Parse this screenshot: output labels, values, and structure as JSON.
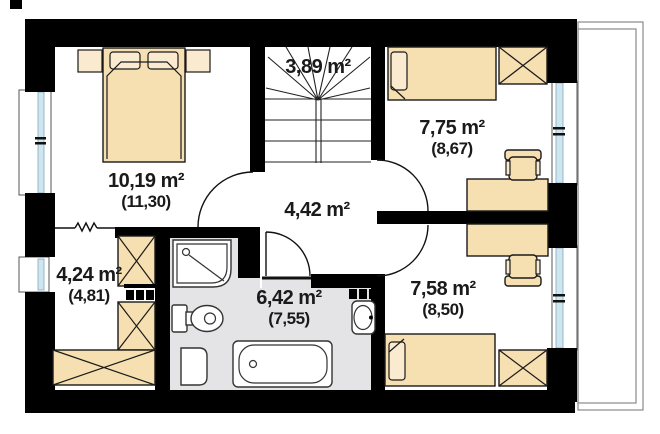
{
  "plan": {
    "type": "floor-plan",
    "rooms": [
      {
        "name": "bedroom-1",
        "area": "10,19 m²",
        "area_ceiling": "(11,30)"
      },
      {
        "name": "staircase",
        "area": "3,89 m²",
        "area_ceiling": ""
      },
      {
        "name": "bedroom-2",
        "area": "7,75 m²",
        "area_ceiling": "(8,67)"
      },
      {
        "name": "hall",
        "area": "4,42 m²",
        "area_ceiling": ""
      },
      {
        "name": "wardrobe-room",
        "area": "4,24 m²",
        "area_ceiling": "(4,81)"
      },
      {
        "name": "bathroom",
        "area": "6,42 m²",
        "area_ceiling": "(7,55)"
      },
      {
        "name": "bedroom-3",
        "area": "7,58 m²",
        "area_ceiling": "(8,50)"
      }
    ],
    "fixtures": [
      "double-bed",
      "nightstand",
      "single-bed",
      "wardrobe",
      "desk",
      "chair",
      "stairs",
      "shower",
      "toilet",
      "washing-machine",
      "bathtub",
      "sink",
      "radiator",
      "window",
      "door",
      "balcony"
    ],
    "colors": {
      "wall": "#000000",
      "furniture": "#f6dfb0",
      "furniture_light": "#f9ead0",
      "bathroom_floor": "#e4e4e6",
      "window_glass": "#cfe6f0",
      "line": "#1a1a1a",
      "balcony_line": "#8a8a8a",
      "background": "#ffffff"
    }
  }
}
